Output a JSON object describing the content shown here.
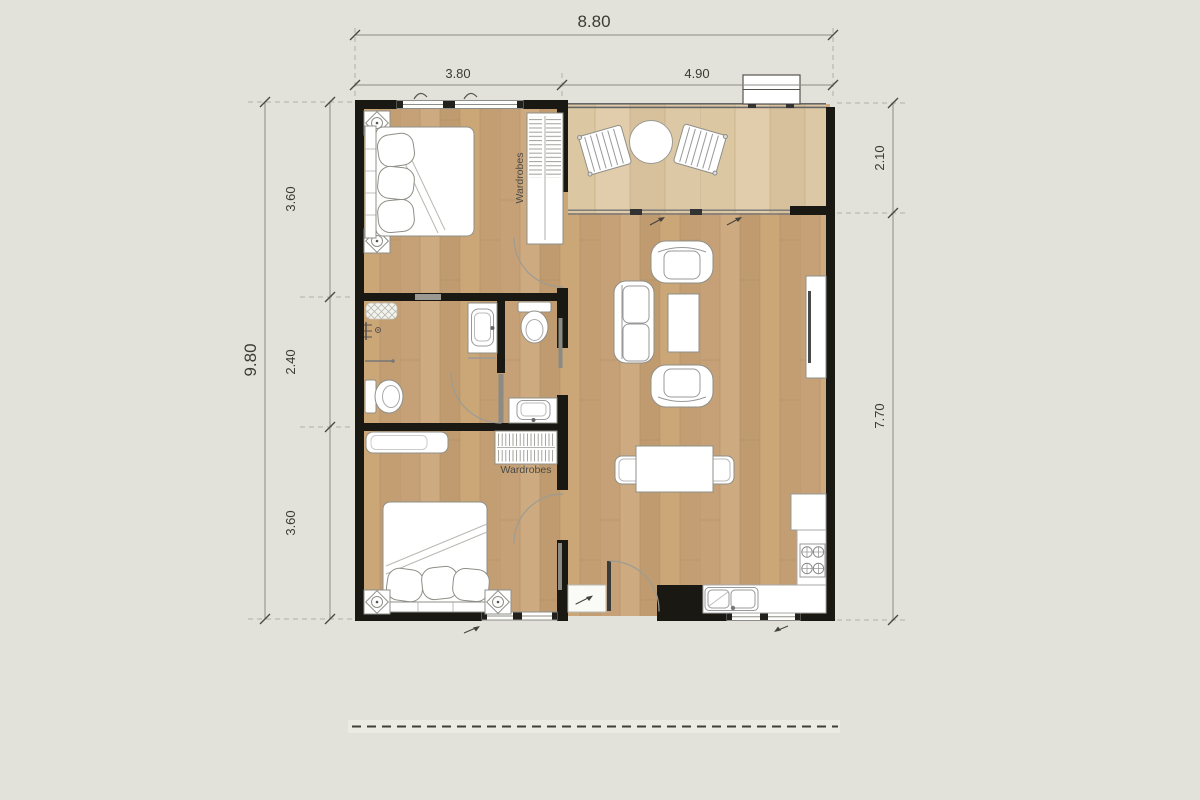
{
  "plan": {
    "type": "apartment-floor-plan",
    "dims": {
      "top_overall": "8.80",
      "top_left": "3.80",
      "top_right": "4.90",
      "left_overall": "9.80",
      "left_top": "3.60",
      "left_middle": "2.40",
      "left_bottom": "3.60",
      "right_top": "2.10",
      "right_bottom": "7.70"
    },
    "labels": {
      "wardrobes_top": "Wardrobes",
      "wardrobes_bottom": "Wardrobes"
    },
    "colors": {
      "background": "#e2e2db",
      "wall": "#1a1813",
      "wood_floor": "#c6a177",
      "balcony_floor": "#dcc7a3",
      "furniture_line": "#8f8f88",
      "dimension_text": "#3b3b36"
    }
  }
}
